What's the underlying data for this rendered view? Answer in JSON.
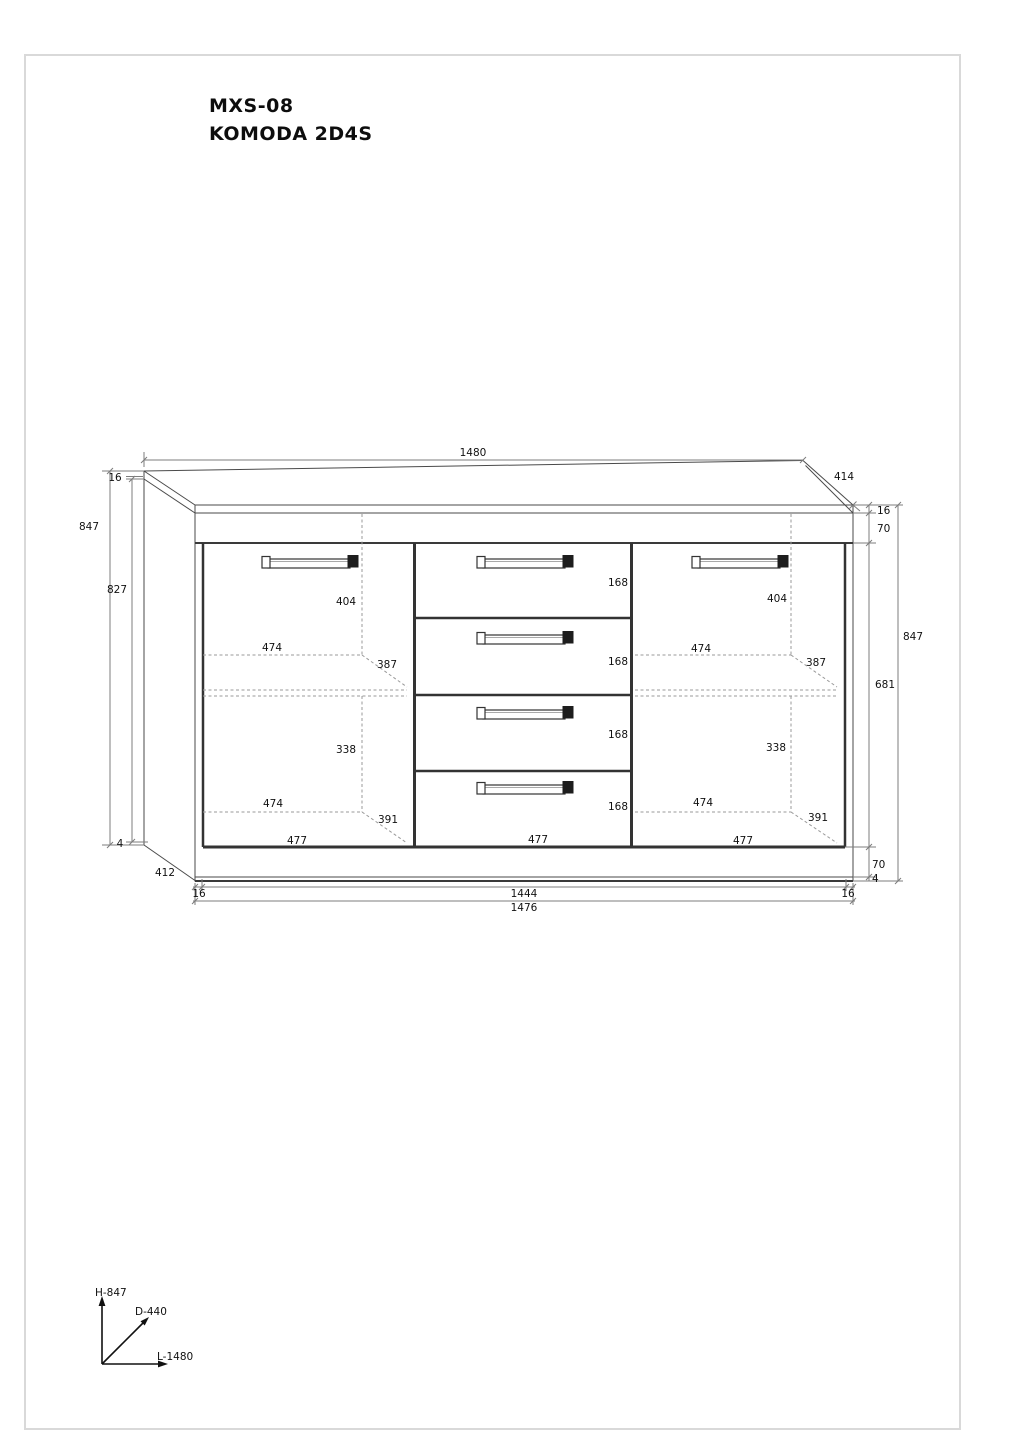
{
  "page": {
    "title_line1": "MXS-08",
    "title_line2": "KOMODA 2D4S"
  },
  "dims": {
    "top_width": "1480",
    "top_depth": "414",
    "top_panel_thickness": "16",
    "height_total_left": "847",
    "carcass_inner_height": "827",
    "base_left": "4",
    "bottom_depth": "412",
    "bottom_left_thickness": "16",
    "bottom_inner_width": "1444",
    "bottom_right_thickness": "16",
    "bottom_total_width": "1476",
    "right_top_thickness": "16",
    "right_top_rail": "70",
    "height_total_right": "847",
    "door_height": "681",
    "right_plinth": "70",
    "right_base": "4"
  },
  "left_door": {
    "handle_to_shelf": "404",
    "shelf_width_upper": "474",
    "shelf_depth_upper": "387",
    "shelf_to_bottom": "338",
    "shelf_width_lower": "474",
    "shelf_depth_lower": "391",
    "door_width": "477"
  },
  "drawers": {
    "heights": [
      "168",
      "168",
      "168",
      "168"
    ],
    "width": "477"
  },
  "right_door": {
    "handle_to_shelf": "404",
    "shelf_width_upper": "474",
    "shelf_depth_upper": "387",
    "shelf_to_bottom": "338",
    "shelf_width_lower": "474",
    "shelf_depth_lower": "391",
    "door_width": "477"
  },
  "axes": {
    "height": "H-847",
    "depth": "D-440",
    "length": "L-1480"
  }
}
